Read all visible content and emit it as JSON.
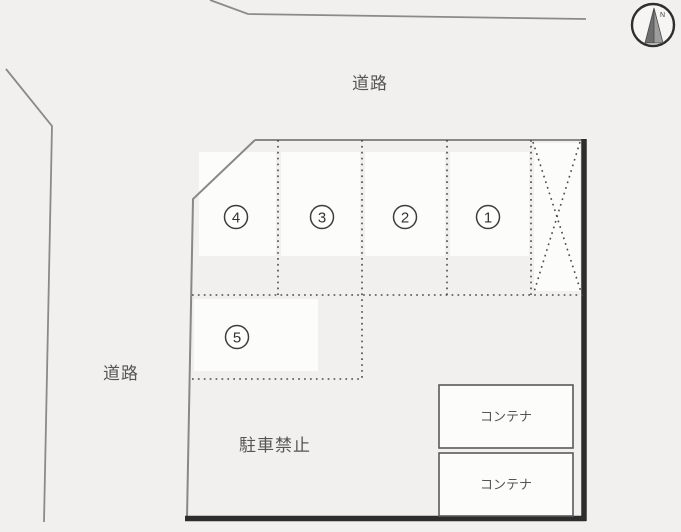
{
  "colors": {
    "background": "#f2f0ee",
    "road_line": "#8a8a8a",
    "lot_thin_line": "#888888",
    "lot_thick_border": "#2d2d2d",
    "dotted_line": "#4a4a4a",
    "text": "#555555",
    "space_fill": "#fcfcfb"
  },
  "labels": {
    "road_top": "道路",
    "road_left": "道路",
    "no_parking": "駐車禁止"
  },
  "spaces": [
    {
      "number": "4"
    },
    {
      "number": "3"
    },
    {
      "number": "2"
    },
    {
      "number": "1"
    },
    {
      "number": "5"
    }
  ],
  "containers": [
    {
      "label": "コンテナ"
    },
    {
      "label": "コンテナ"
    }
  ],
  "compass": {
    "north_label": "N"
  }
}
